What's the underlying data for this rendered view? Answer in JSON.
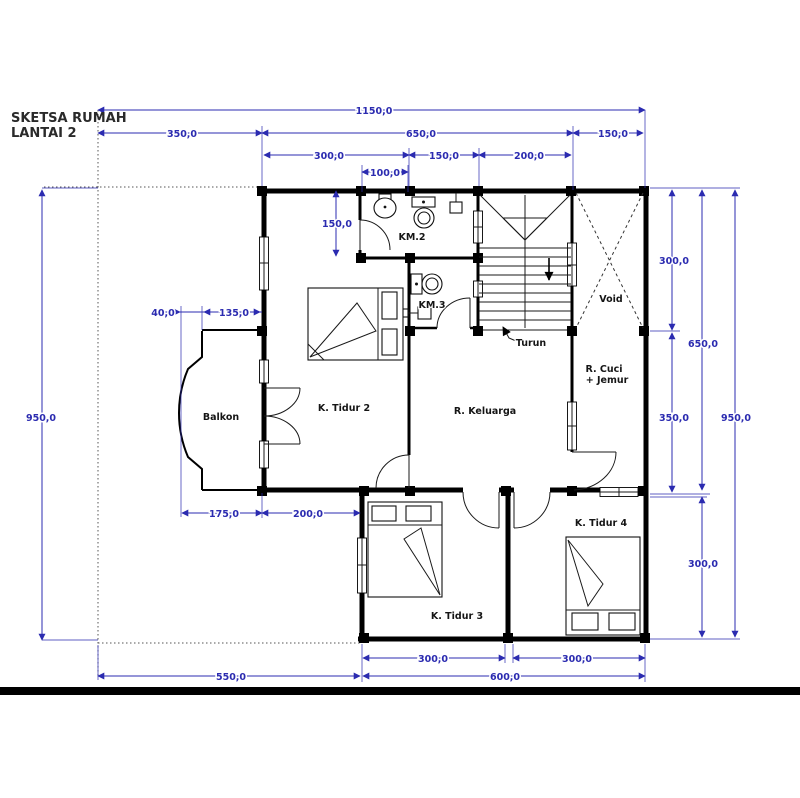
{
  "title": {
    "line1": "SKETSA RUMAH",
    "line2": "LANTAI 2"
  },
  "colors": {
    "dimension": "#2b2bb0",
    "wall": "#000000",
    "label": "#151515",
    "bar": "#000000"
  },
  "rooms": {
    "km2": "KM.2",
    "km3": "KM.3",
    "void": "Void",
    "turun": "Turun",
    "r_cuci_line1": "R. Cuci",
    "r_cuci_line2": "+ Jemur",
    "balkon": "Balkon",
    "k_tidur2": "K. Tidur 2",
    "r_keluarga": "R. Keluarga",
    "k_tidur3": "K. Tidur 3",
    "k_tidur4": "K. Tidur 4"
  },
  "dimensions": {
    "top_total": "1150,0",
    "top_left": "350,0",
    "top_mid": "650,0",
    "top_right": "150,0",
    "row3_left": "300,0",
    "row3_mid": "150,0",
    "row3_right": "200,0",
    "row4": "100,0",
    "left_total": "950,0",
    "left_offset": "40,0",
    "left_balkon": "135,0",
    "km2_height": "150,0",
    "right_void": "300,0",
    "right_cuci": "350,0",
    "right_main": "650,0",
    "right_lower": "300,0",
    "right_total": "950,0",
    "bottom_balkon": "175,0",
    "bottom_tidur2": "200,0",
    "bottom_tidur3": "300,0",
    "bottom_tidur4": "300,0",
    "bottom_left_total": "550,0",
    "bottom_right_total": "600,0"
  }
}
